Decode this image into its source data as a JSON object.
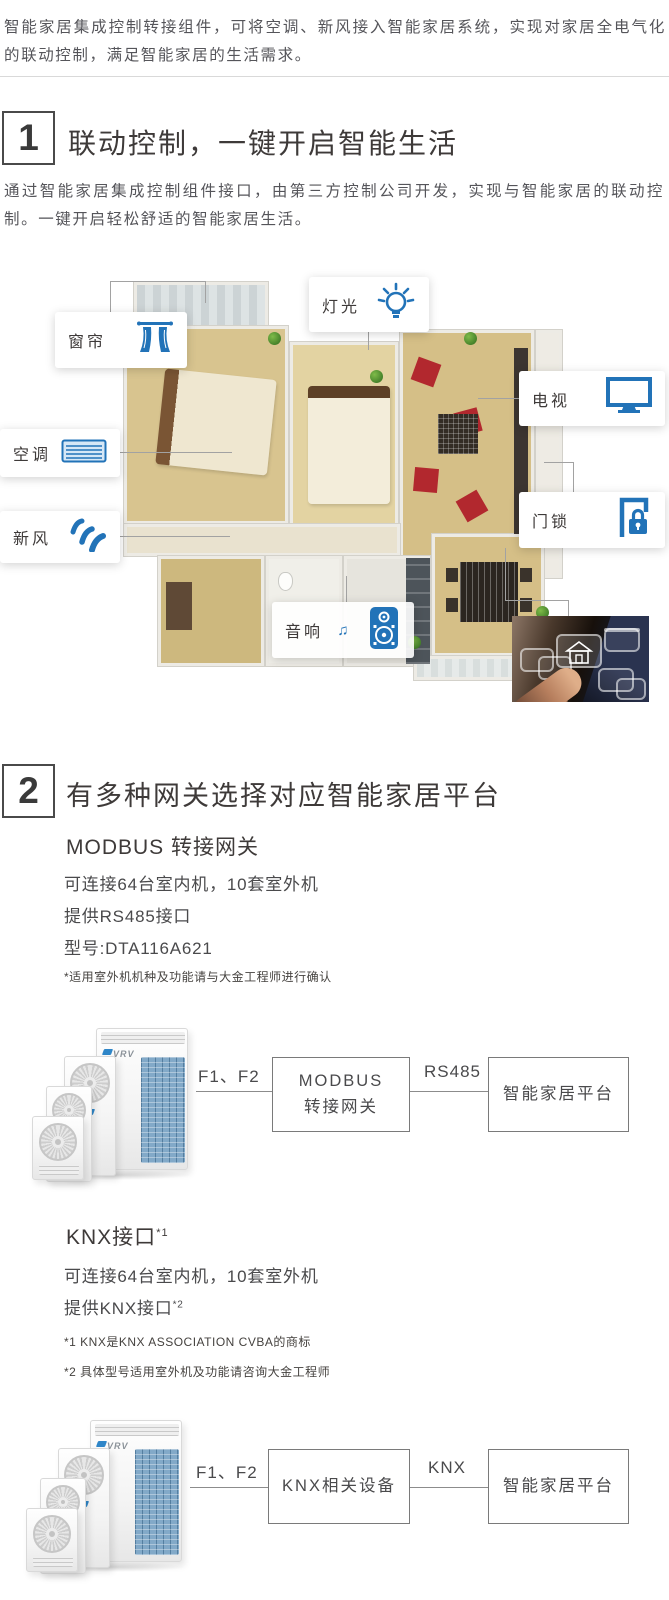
{
  "colors": {
    "accent_blue": "#2273b8",
    "text_dark": "#3e3a39",
    "text_gray": "#55555a"
  },
  "intro": {
    "text": "智能家居集成控制转接组件，可将空调、新风接入智能家居系统，实现对家居全电气化的联动控制，满足智能家居的生活需求。"
  },
  "section1": {
    "number": "1",
    "title": "联动控制，一键开启智能生活",
    "description": "通过智能家居集成控制组件接口，由第三方控制公司开发，实现与智能家居的联动控制。一键开启轻松舒适的智能家居生活。",
    "labels": {
      "curtain": "窗帘",
      "light": "灯光",
      "tv": "电视",
      "ac": "空调",
      "fresh_air": "新风",
      "door_lock": "门锁",
      "audio": "音响"
    }
  },
  "section2": {
    "number": "2",
    "title": "有多种网关选择对应智能家居平台",
    "modbus": {
      "subtitle": "MODBUS 转接网关",
      "spec1": "可连接64台室内机，10套室外机",
      "spec2": "提供RS485接口",
      "spec3": "型号:DTA116A621",
      "footnote": "*适用室外机机种及功能请与大金工程师进行确认",
      "diagram": {
        "product_logo": "VRV",
        "wire_label": "F1、F2",
        "gateway_line1": "MODBUS",
        "gateway_line2": "转接网关",
        "protocol_label": "RS485",
        "platform_label": "智能家居平台"
      }
    },
    "knx": {
      "subtitle": "KNX接口",
      "subtitle_sup": "*1",
      "spec1": "可连接64台室内机，10套室外机",
      "spec2": "提供KNX接口",
      "spec2_sup": "*2",
      "note1": "*1 KNX是KNX ASSOCIATION CVBA的商标",
      "note2": "*2 具体型号适用室外机及功能请咨询大金工程师",
      "diagram": {
        "product_logo": "VRV",
        "wire_label": "F1、F2",
        "gateway_label": "KNX相关设备",
        "protocol_label": "KNX",
        "platform_label": "智能家居平台"
      }
    }
  }
}
